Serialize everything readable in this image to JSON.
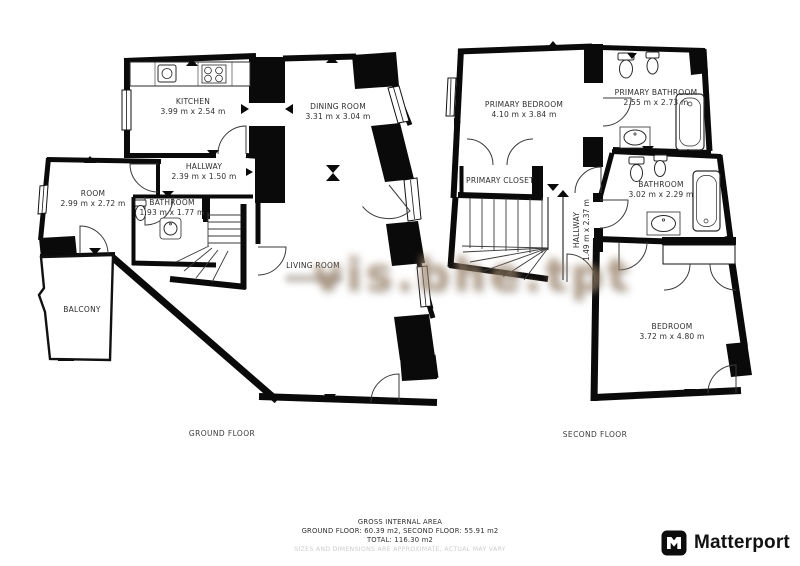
{
  "watermark": {
    "text": "vis.bhe.tpt"
  },
  "ground_floor": {
    "caption": "GROUND FLOOR",
    "rooms": {
      "kitchen": {
        "name": "KITCHEN",
        "dims": "3.99 m x 2.54 m"
      },
      "dining_room": {
        "name": "DINING ROOM",
        "dims": "3.31 m x 3.04 m"
      },
      "hallway": {
        "name": "HALLWAY",
        "dims": "2.39 m x 1.50 m"
      },
      "room": {
        "name": "ROOM",
        "dims": "2.99 m x 2.72 m"
      },
      "bathroom": {
        "name": "BATHROOM",
        "dims": "1.93 m x 1.77 m"
      },
      "living_room": {
        "name": "LIVING ROOM",
        "dims": ""
      },
      "balcony": {
        "name": "BALCONY",
        "dims": ""
      }
    }
  },
  "second_floor": {
    "caption": "SECOND FLOOR",
    "rooms": {
      "primary_bedroom": {
        "name": "PRIMARY BEDROOM",
        "dims": "4.10 m x 3.84 m"
      },
      "primary_bathroom": {
        "name": "PRIMARY BATHROOM",
        "dims": "2.55 m x 2.73 m"
      },
      "primary_closet": {
        "name": "PRIMARY CLOSET",
        "dims": ""
      },
      "bathroom": {
        "name": "BATHROOM",
        "dims": "3.02 m x 2.29 m"
      },
      "hallway": {
        "name": "HALLWAY",
        "dims": "1.49 m x 2.37 m"
      },
      "bedroom": {
        "name": "BEDROOM",
        "dims": "3.72 m x 4.80 m"
      }
    }
  },
  "footer": {
    "title": "GROSS INTERNAL AREA",
    "areas": "GROUND FLOOR: 60.39 m2, SECOND FLOOR: 55.91 m2",
    "total": "TOTAL: 116.30 m2",
    "disclaimer": "SIZES AND DIMENSIONS ARE APPROXIMATE, ACTUAL MAY VARY"
  },
  "branding": {
    "logo_text": "Matterport"
  }
}
